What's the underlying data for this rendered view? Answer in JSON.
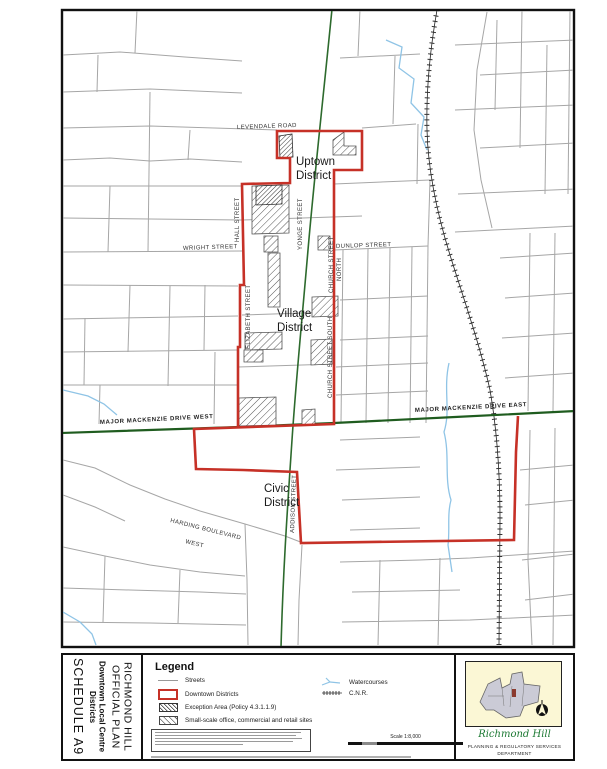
{
  "title_block": {
    "org_line1": "RICHMOND HILL",
    "org_line2": "OFFICIAL PLAN",
    "doc_line1": "Downtown Local Centre",
    "doc_line2": "Districts",
    "schedule": "SCHEDULE A9"
  },
  "legend": {
    "title": "Legend",
    "items": [
      {
        "label": "Streets"
      },
      {
        "label": "Downtown Districts"
      },
      {
        "label": "Exception Area (Policy 4.3.1.1.9)"
      },
      {
        "label": "Small-scale office, commercial and retail sites"
      }
    ],
    "items_right": [
      {
        "label": "Watercourses"
      },
      {
        "label": "C.N.R."
      }
    ],
    "scale_label": "Scale 1:8,000"
  },
  "map": {
    "districts": [
      {
        "line1": "Uptown",
        "line2": "District"
      },
      {
        "line1": "Village",
        "line2": "District"
      },
      {
        "line1": "Civic",
        "line2": "District"
      }
    ],
    "streets": {
      "levendale": "LEVENDALE  ROAD",
      "hall": "HALL STREET",
      "yonge": "YONGE STREET",
      "wright": "WRIGHT STREET",
      "dunlop": "DUNLOP STREET",
      "church_north_1": "CHURCH STREET",
      "church_north_2": "NORTH",
      "elizabeth": "ELIZABETH STREET",
      "church_south": "CHURCH STREET SOUTH",
      "majmack_west": "MAJOR MACKENZIE DRIVE WEST",
      "majmack_east": "MAJOR MACKENZIE DRIVE EAST",
      "addison": "ADDISON STREET",
      "harding_1": "HARDING BOULEVARD",
      "harding_2": "WEST"
    }
  },
  "footer": {
    "logo_text": "Richmond Hill",
    "dept_line1": "PLANNING & REGULATORY SERVICES",
    "dept_line2": "DEPARTMENT"
  },
  "colors": {
    "district_boundary": "#C63127",
    "major_road": "#2D6A2D",
    "street": "#A6A6A6",
    "watercourse": "#8FC4E6",
    "railway": "#222222",
    "inset_bg": "#FBF7D5",
    "logo_green": "#1E7A34"
  }
}
